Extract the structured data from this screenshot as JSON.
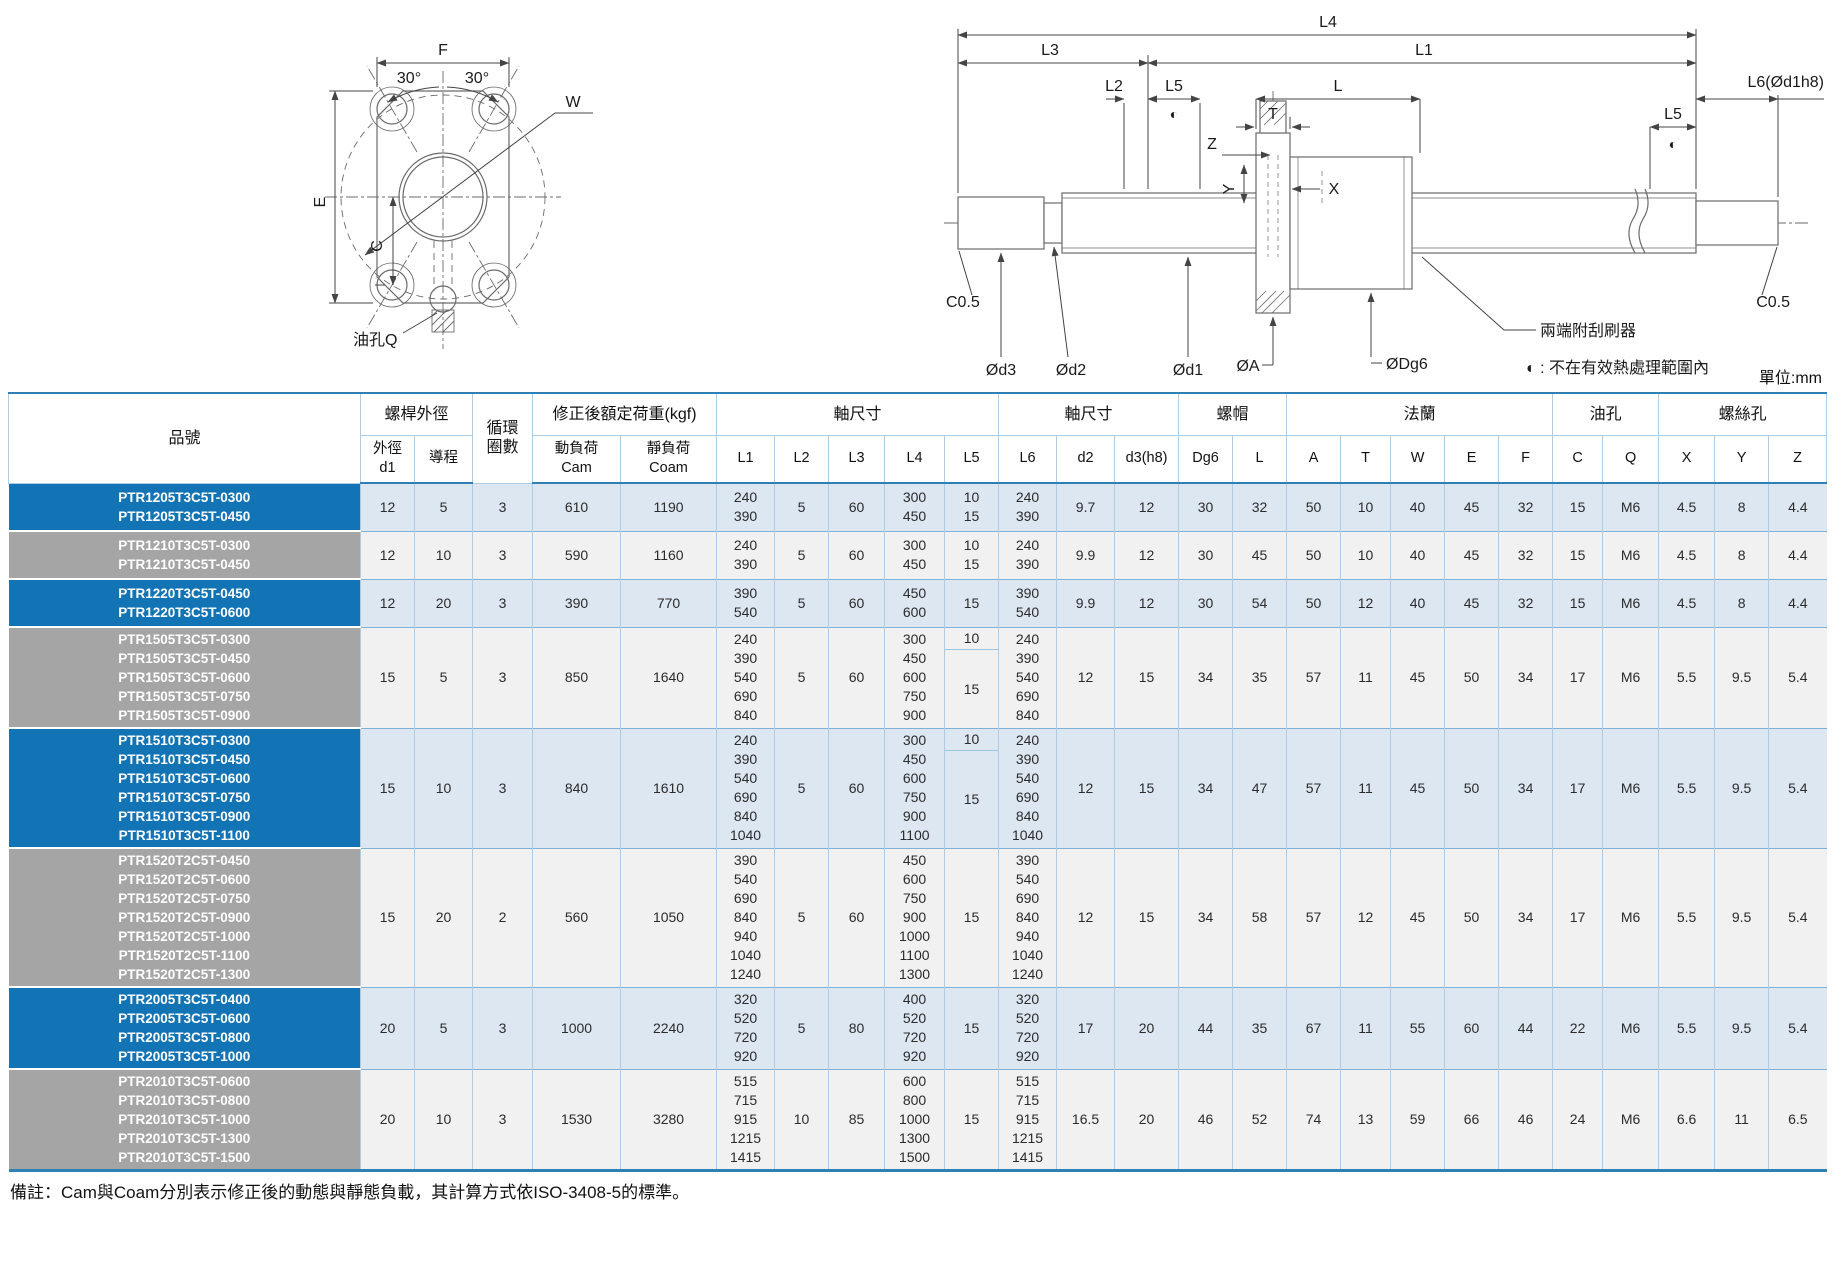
{
  "unit_label": "單位:mm",
  "note": "備註：Cam與Coam分別表示修正後的動態與靜態負載，其計算方式依ISO-3408-5的標準。",
  "drawing_left": {
    "F": "F",
    "angle_left": "30°",
    "angle_right": "30°",
    "E": "E",
    "C": "C",
    "W": "W",
    "oil_hole": "油孔Q"
  },
  "drawing_right": {
    "L4": "L4",
    "L3": "L3",
    "L1": "L1",
    "L2": "L2",
    "L5_left": "L5",
    "L": "L",
    "T": "T",
    "Z": "Z",
    "Y": "Y",
    "X": "X",
    "L5_right": "L5",
    "L6": "L6(Ød1h8)",
    "c05_left": "C0.5",
    "c05_right": "C0.5",
    "d3": "Ød3",
    "d2": "Ød2",
    "d1": "Ød1",
    "A": "ØA",
    "Dg6": "ØDg6",
    "half_symbol_left": "◐",
    "half_symbol_right": "◐",
    "wiper_note": "兩端附刮刷器",
    "heat_note": "◐ : 不在有效熱處理範圍內"
  },
  "table": {
    "headers": {
      "part_no": "品號",
      "screw_od": "螺桿外徑",
      "circuits": "循環\n圈數",
      "rated_load": "修正後額定荷重(kgf)",
      "shaft_dim1": "軸尺寸",
      "shaft_dim2": "軸尺寸",
      "nut": "螺帽",
      "flange": "法蘭",
      "oil": "油孔",
      "screw_holes": "螺絲孔",
      "sub": {
        "d1": "外徑\nd1",
        "lead": "導程",
        "cam": "動負荷\nCam",
        "coam": "靜負荷\nCoam",
        "L1": "L1",
        "L2": "L2",
        "L3": "L3",
        "L4": "L4",
        "L5": "L5",
        "L6": "L6",
        "d2": "d2",
        "d3": "d3(h8)",
        "Dg6": "Dg6",
        "L": "L",
        "A": "A",
        "T": "T",
        "W": "W",
        "E": "E",
        "F": "F",
        "C": "C",
        "Q": "Q",
        "X": "X",
        "Y": "Y",
        "Z": "Z"
      }
    },
    "rows": [
      {
        "models": "PTR1205T3C5T-0300\nPTR1205T3C5T-0450",
        "d1": "12",
        "lead": "5",
        "circuits": "3",
        "cam": "610",
        "coam": "1190",
        "L1": "240\n390",
        "L2": "5",
        "L3": "60",
        "L4": "300\n450",
        "L5": "10\n15",
        "L6": "240\n390",
        "d2": "9.7",
        "d3": "12",
        "Dg6": "30",
        "L": "32",
        "A": "50",
        "T": "10",
        "W": "40",
        "E": "45",
        "F": "32",
        "C": "15",
        "Q": "M6",
        "X": "4.5",
        "Y": "8",
        "Z": "4.4"
      },
      {
        "models": "PTR1210T3C5T-0300\nPTR1210T3C5T-0450",
        "d1": "12",
        "lead": "10",
        "circuits": "3",
        "cam": "590",
        "coam": "1160",
        "L1": "240\n390",
        "L2": "5",
        "L3": "60",
        "L4": "300\n450",
        "L5": "10\n15",
        "L6": "240\n390",
        "d2": "9.9",
        "d3": "12",
        "Dg6": "30",
        "L": "45",
        "A": "50",
        "T": "10",
        "W": "40",
        "E": "45",
        "F": "32",
        "C": "15",
        "Q": "M6",
        "X": "4.5",
        "Y": "8",
        "Z": "4.4"
      },
      {
        "models": "PTR1220T3C5T-0450\nPTR1220T3C5T-0600",
        "d1": "12",
        "lead": "20",
        "circuits": "3",
        "cam": "390",
        "coam": "770",
        "L1": "390\n540",
        "L2": "5",
        "L3": "60",
        "L4": "450\n600",
        "L5": "15",
        "L6": "390\n540",
        "d2": "9.9",
        "d3": "12",
        "Dg6": "30",
        "L": "54",
        "A": "50",
        "T": "12",
        "W": "40",
        "E": "45",
        "F": "32",
        "C": "15",
        "Q": "M6",
        "X": "4.5",
        "Y": "8",
        "Z": "4.4"
      },
      {
        "models": "PTR1505T3C5T-0300\nPTR1505T3C5T-0450\nPTR1505T3C5T-0600\nPTR1505T3C5T-0750\nPTR1505T3C5T-0900",
        "d1": "15",
        "lead": "5",
        "circuits": "3",
        "cam": "850",
        "coam": "1640",
        "L1": "240\n390\n540\n690\n840",
        "L2": "5",
        "L3": "60",
        "L4": "300\n450\n600\n750\n900",
        "L5_top": "10",
        "L5_bottom": "15",
        "L6": "240\n390\n540\n690\n840",
        "d2": "12",
        "d3": "15",
        "Dg6": "34",
        "L": "35",
        "A": "57",
        "T": "11",
        "W": "45",
        "E": "50",
        "F": "34",
        "C": "17",
        "Q": "M6",
        "X": "5.5",
        "Y": "9.5",
        "Z": "5.4"
      },
      {
        "models": "PTR1510T3C5T-0300\nPTR1510T3C5T-0450\nPTR1510T3C5T-0600\nPTR1510T3C5T-0750\nPTR1510T3C5T-0900\nPTR1510T3C5T-1100",
        "d1": "15",
        "lead": "10",
        "circuits": "3",
        "cam": "840",
        "coam": "1610",
        "L1": "240\n390\n540\n690\n840\n1040",
        "L2": "5",
        "L3": "60",
        "L4": "300\n450\n600\n750\n900\n1100",
        "L5_top": "10",
        "L5_bottom": "15",
        "L6": "240\n390\n540\n690\n840\n1040",
        "d2": "12",
        "d3": "15",
        "Dg6": "34",
        "L": "47",
        "A": "57",
        "T": "11",
        "W": "45",
        "E": "50",
        "F": "34",
        "C": "17",
        "Q": "M6",
        "X": "5.5",
        "Y": "9.5",
        "Z": "5.4"
      },
      {
        "models": "PTR1520T2C5T-0450\nPTR1520T2C5T-0600\nPTR1520T2C5T-0750\nPTR1520T2C5T-0900\nPTR1520T2C5T-1000\nPTR1520T2C5T-1100\nPTR1520T2C5T-1300",
        "d1": "15",
        "lead": "20",
        "circuits": "2",
        "cam": "560",
        "coam": "1050",
        "L1": "390\n540\n690\n840\n940\n1040\n1240",
        "L2": "5",
        "L3": "60",
        "L4": "450\n600\n750\n900\n1000\n1100\n1300",
        "L5": "15",
        "L6": "390\n540\n690\n840\n940\n1040\n1240",
        "d2": "12",
        "d3": "15",
        "Dg6": "34",
        "L": "58",
        "A": "57",
        "T": "12",
        "W": "45",
        "E": "50",
        "F": "34",
        "C": "17",
        "Q": "M6",
        "X": "5.5",
        "Y": "9.5",
        "Z": "5.4"
      },
      {
        "models": "PTR2005T3C5T-0400\nPTR2005T3C5T-0600\nPTR2005T3C5T-0800\nPTR2005T3C5T-1000",
        "d1": "20",
        "lead": "5",
        "circuits": "3",
        "cam": "1000",
        "coam": "2240",
        "L1": "320\n520\n720\n920",
        "L2": "5",
        "L3": "80",
        "L4": "400\n520\n720\n920",
        "L5": "15",
        "L6": "320\n520\n720\n920",
        "d2": "17",
        "d3": "20",
        "Dg6": "44",
        "L": "35",
        "A": "67",
        "T": "11",
        "W": "55",
        "E": "60",
        "F": "44",
        "C": "22",
        "Q": "M6",
        "X": "5.5",
        "Y": "9.5",
        "Z": "5.4"
      },
      {
        "models": "PTR2010T3C5T-0600\nPTR2010T3C5T-0800\nPTR2010T3C5T-1000\nPTR2010T3C5T-1300\nPTR2010T3C5T-1500",
        "d1": "20",
        "lead": "10",
        "circuits": "3",
        "cam": "1530",
        "coam": "3280",
        "L1": "515\n715\n915\n1215\n1415",
        "L2": "10",
        "L3": "85",
        "L4": "600\n800\n1000\n1300\n1500",
        "L5": "15",
        "L6": "515\n715\n915\n1215\n1415",
        "d2": "16.5",
        "d3": "20",
        "Dg6": "46",
        "L": "52",
        "A": "74",
        "T": "13",
        "W": "59",
        "E": "66",
        "F": "46",
        "C": "24",
        "Q": "M6",
        "X": "6.6",
        "Y": "11",
        "Z": "6.5"
      }
    ]
  }
}
